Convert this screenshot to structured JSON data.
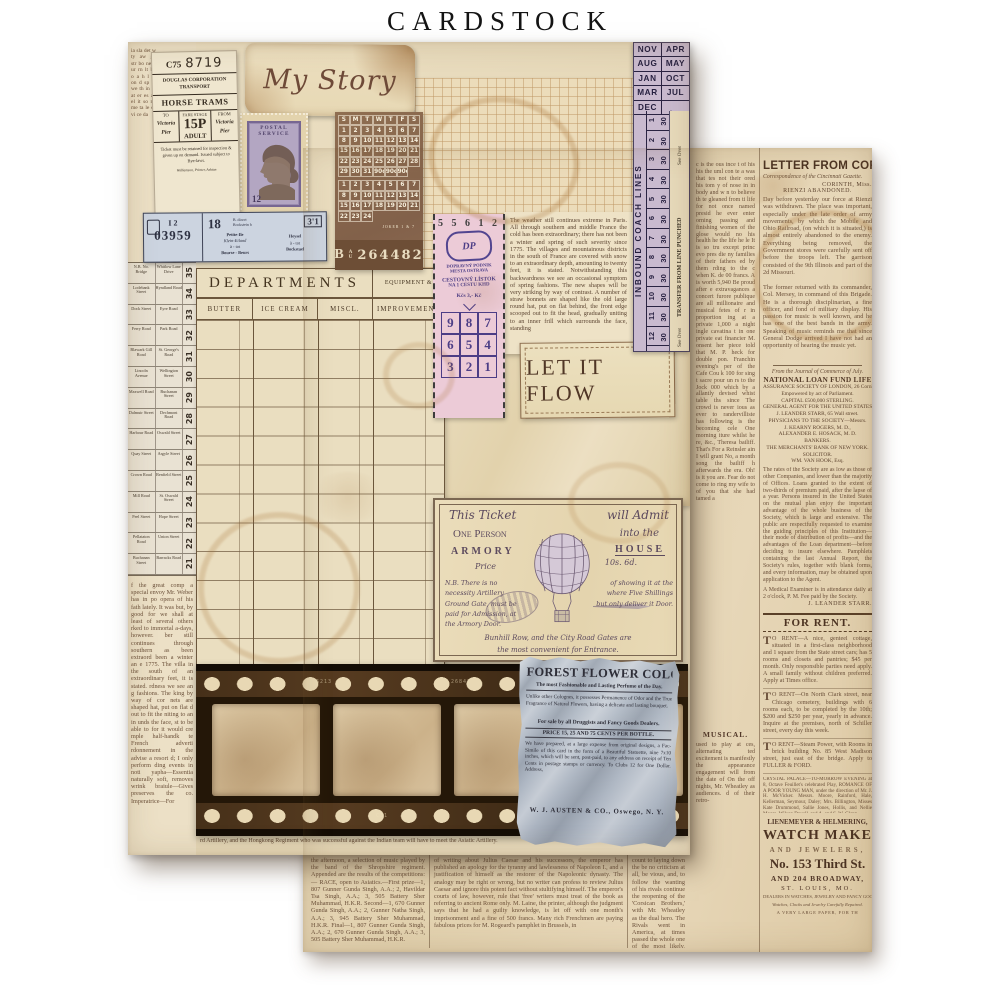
{
  "title": "CARDSTOCK",
  "palette": {
    "background": "#ffffff",
    "paper_cream": "#ece0c6",
    "newsprint_tan": "#e6d6b4",
    "ink_brown": "#5d4430",
    "ticket_lavender": "#c9bacf",
    "ticket_pink": "#eccbd7",
    "stamp_purple": "#4c3d86",
    "film_brown": "#2a1b0e",
    "cologne_blue": "#b9c1cb",
    "calendar_brown": "#8a6850"
  },
  "a": {
    "np_top": "ia sla det w ty aw go str bo ne y ur rn lt bo o a h l m on d sp ar we th in re at er es an el it so no me ta le os vi ce da",
    "np_left": "f the great comp a special envoy Mr. Weber has in po opera of his fath lately. It was but, by good for we shall at least of several others rked to immortal a-days, however. ber still continues through southern as been extraord been a winter an e 1775. The villa in the south of an extraordinary feet, it is stated. rdness we see an g fashions. The king by way of cor nets are shaped hat, put on flat d out to fit the niting to an in unds the face, st to be able to for it would cre mple half-handk te French adverti rdonnement in the advise a resort d; I only perform ding events in noti yapha—Essentia naturally soft, removes wrink braiule—Gives preserves the co. Imperatrice—For",
    "np_bottom": "rd Artillery, and the Hongkong Regiment who was successful against the Indian team will have to meet the Asiatic Artillery.",
    "bus": {
      "rows": [
        {
          "a": "N.B. No. Bridge",
          "b": "Whitlow Lane Drive",
          "n": "35"
        },
        {
          "a": "Lodebank Street",
          "b": "Hyndland Road",
          "n": "34"
        },
        {
          "a": "Dock Street",
          "b": "Eyre Road",
          "n": "33"
        },
        {
          "a": "Ferry Road",
          "b": "Park Road",
          "n": "32"
        },
        {
          "a": "Blawark Gill Road",
          "b": "St. George's Road",
          "n": "31"
        },
        {
          "a": "Lincoln Avenue",
          "b": "Wellington Street",
          "n": "30"
        },
        {
          "a": "Maxwell Road",
          "b": "Buchanan Street",
          "n": "29"
        },
        {
          "a": "Dalmuir Street",
          "b": "Dechmont Road",
          "n": "28"
        },
        {
          "a": "Harbour Road",
          "b": "Oswald Street",
          "n": "27"
        },
        {
          "a": "Quay Street",
          "b": "Argyle Street",
          "n": "26"
        },
        {
          "a": "Crown Road",
          "b": "Renfield Street",
          "n": "25"
        },
        {
          "a": "Mill Road",
          "b": "St. Oswald Street",
          "n": "24"
        },
        {
          "a": "Peel Street",
          "b": "Hope Street",
          "n": "23"
        },
        {
          "a": "Pellataton Road",
          "b": "Union Street",
          "n": "22"
        },
        {
          "a": "Buchanan Street",
          "b": "Barracks Road",
          "n": "21"
        }
      ]
    },
    "horse": {
      "c": "C75",
      "num": "8719",
      "co1": "DOUGLAS CORPORATION",
      "co2": "TRANSPORT",
      "name": "HORSE TRAMS",
      "to": "TO",
      "fare": "FARE STAGE",
      "from": "FROM",
      "to_v1": "Victoria",
      "to_v2": "Pier",
      "fare_v": "15P",
      "fare_c": "ADULT",
      "from_v1": "Victoria",
      "from_v2": "Pier",
      "cond": "Ticket must be retained for inspection & given up on demand. Issued subject to Bye-laws.",
      "printer": "Williamson, Printer, Ashton"
    },
    "story": "My Story",
    "stamp": {
      "h": "POSTAL SERVICE",
      "v": "12"
    },
    "cal": {
      "days": [
        "S",
        "M",
        "T",
        "W",
        "T",
        "F",
        "S"
      ],
      "m1": [
        "1",
        "2",
        "3",
        "4",
        "5",
        "6",
        "7",
        "8",
        "9",
        "10",
        "11",
        "12",
        "13",
        "14",
        "15",
        "16",
        "17",
        "18",
        "19",
        "20",
        "21",
        "22",
        "23",
        "24",
        "25",
        "26",
        "27",
        "28",
        "29",
        "30",
        "31",
        "90c",
        "90c",
        "90c"
      ],
      "m2": [
        "1",
        "2",
        "3",
        "4",
        "5",
        "6",
        "7",
        "8",
        "9",
        "10",
        "11",
        "12",
        "13",
        "14",
        "15",
        "16",
        "17",
        "18",
        "19",
        "20",
        "21",
        "22",
        "23",
        "24"
      ],
      "note": "JOKER 1 & 7"
    },
    "serial": {
      "p": "B",
      "sup": "A",
      "sub": "U",
      "n": "264482"
    },
    "blue": {
      "s1": "I 2",
      "s2": "03959",
      "n": "18",
      "note1": "B. direct",
      "note2": "Bockstein b",
      "fare": "3'1",
      "l1": "Petite-Ile",
      "l2": "Klein-Eiland",
      "l3": "à - tot",
      "l4": "Bourse - Beurs",
      "r1": "Heysel",
      "r2": "à - tot",
      "r3": "Bockstael"
    },
    "strip": {
      "months": [
        {
          "l": "NOV",
          "r": "APR"
        },
        {
          "l": "AUG",
          "r": "MAY"
        },
        {
          "l": "JAN",
          "r": "OCT"
        },
        {
          "l": "MAR",
          "r": "JUL"
        },
        {
          "l": "DEC",
          "r": ""
        }
      ],
      "rows": [
        {
          "n": "1",
          "v": "30"
        },
        {
          "n": "2",
          "v": "30"
        },
        {
          "n": "3",
          "v": "30"
        },
        {
          "n": "4",
          "v": "30"
        },
        {
          "n": "5",
          "v": "30"
        },
        {
          "n": "6",
          "v": "30"
        },
        {
          "n": "7",
          "v": "30"
        },
        {
          "n": "8",
          "v": "30"
        },
        {
          "n": "9",
          "v": "30"
        },
        {
          "n": "10",
          "v": "30"
        },
        {
          "n": "11",
          "v": "30"
        },
        {
          "n": "12",
          "v": "30"
        }
      ],
      "inbound": "INBOUND COACH LINES",
      "see": "See Over",
      "transfer": "TRANSFER FROM LINE PUNCHED"
    },
    "pink": {
      "serial": "5 5 6 1 2",
      "logo": "DP",
      "co1": "DOPRAVNÝ PODNIK",
      "co2": "MESTA OSTRAVA",
      "t1": "CESTOVNÝ LÍSTOK",
      "t2": "NA 1 CESTU KHD",
      "price": "Kčs 3,- Kč",
      "digits": [
        "9",
        "8",
        "7",
        "6",
        "5",
        "4",
        "3",
        "2",
        "1"
      ]
    },
    "weather": "The weather still continues extreme in Paris. All through southern and middle France the cold has been extraordinary; there has not been a winter and spring of such severity since 1775. The villages and mountainous districts in the south of France are covered with snow to an extraordinary depth, amounting to twenty feet, it is stated. Notwithstanding this backwardness we see an occasional symptom of spring fashions. The new shapes will be very striking by way of contrast. A number of straw bonnets are shaped like the old large round hat, put on flat behind, the front edge scooped out to fit the head, gradually uniting to an inner frill which surrounds the face, standing",
    "dept": {
      "title": "DEPARTMENTS",
      "corner": "EQUIPMENT &",
      "cols": [
        "BUTTER",
        "ICE CREAM",
        "MISCL.",
        "IMPROVEMENT"
      ]
    },
    "flow": "LET IT FLOW",
    "armory": {
      "r1a": "This Ticket",
      "r1b": "will Admit",
      "r2a": "One Person",
      "r2b": "into the",
      "r3a": "ARMORY",
      "r3b": "HOUSE",
      "pl": "Price",
      "pv": "10s. 6d.",
      "bl": "N.B. There is no necessity Artillery Ground Gate, must be paid for Admission, at the Armory Door.",
      "br": "of showing it at the where Five Shillings but only deliver it Door.",
      "f1": "Bunhill Row, and the City Road Gates are",
      "f2": "the most convenient for Entrance."
    },
    "film": {
      "m1": "6213",
      "m2": "26847",
      "m3": "57",
      "m4": "C31",
      "m5": "110"
    },
    "cologne": {
      "title": "FOREST FLOWER COLOGNE,",
      "sub": "The most Fashionable and Lasting Perfume of the Day.",
      "p1": "Unlike other Colognes, it possesses Permanence of Odor and the True Fragrance of Natural Flowers, having a delicate and lasting bouquet.",
      "sale": "For sale by all Druggists and Fancy Goods Dealers.",
      "price": "PRICE 15, 25 AND 75 CENTS PER BOTTLE.",
      "p2": "We have prepared, at a large expense from original designs, a Fac-Simile of this card in the form of a Beautiful Statuette, nine 7x10 inches, which will be sent, post-paid, to any address on receipt of Ten Cents in postage stamps or currency. To Clubs 12 for One Dollar. Address,",
      "sig": "W. J. AUSTEN & CO., Oswego, N. Y."
    }
  },
  "b": {
    "sliver": "c is the ous ince t of his his the uml con te a was that tes not their ored his tom y of nose in in body and w n to believe th te gleaned from ti life for not once named presid he ever enter orning passing and finishing women of the glose would no his health he the life he le It is so tru except princ evo pres die ny families of their fathers ed by them rding to the c when K. de 00 francs. A is worth 5,940 Be proud after e extravagances a concert furore publique are all millionaire and musical fetes of r in proportion ing at a private 1,000 a night ingle cavatina t in one private eat financier M. onsent her piece told that M. P. heck for double pon. Franchin evening's per of the Cafe Cou k 100 for sing t sacre pour un rs to the Jock 000 which by a allantly devised whist table ths since The crowd is never ious as ever to randervilliste has following is the becoming cele One morning iture whilst he re, &c., Theresa bailiff. That's For a Reinsler ain I will grant No, a month song the bailiff h afterwards the era. Oh! is it you are. Fear do not come to ring my wife to of you that she had tamed a",
    "musical_h": "MUSICAL.",
    "musical": "used to play at ces, alternating ted excitement is manifestly the appearance engagement will from the date of On the off nights, Mr. Wheatley as audiences. d of their retro-",
    "headline": "LETTER FROM CORINTH.",
    "dateline": "Correspondence of the Cincinnati Gazette.",
    "place": "CORINTH, Miss.",
    "subhead": "RIENZI ABANDONED.",
    "art1": "Day before yesterday our force at Rienzi was withdrawn. The place was important, especially under the late order of army movements, by which the Mobile and Ohio Railroad, (on which it is situated,) is almost entirely abandoned to the enemy. Everything being removed, the Government stores were carefully sent off before the troops left. The garrison consisted of the 9th Illinois and part of the 2d Missouri.",
    "art2": "The former returned with its commander, Col. Mersey, in command of this Brigade. He is a thorough disciplinarian, a fine officer, and fond of military display. His passion for music is well known, and he has one of the best bands in the army. Speaking of music reminds me that since General Dodge arrived I have not had an opportunity of hearing the music yet.",
    "credit": "From the Journal of Commerce of July.",
    "natl_title": "NATIONAL LOAN FUND LIFE",
    "natl_lines": [
      "ASSURANCE SOCIETY OF LONDON, 26 Cornhill.",
      "Empowered by act of Parliament.",
      "CAPITAL £500,000 STERLING.",
      "GENERAL AGENT FOR THE UNITED STATES,",
      "J. LEANDER STARR, 65 Wall street.",
      "PHYSICIANS TO THE SOCIETY—Messrs.",
      "J. KEARNY ROGERS, M. D.,",
      "ALEXANDER E. HOSACK, M. D.",
      "BANKERS.",
      "THE MERCHANTS' BANK OF NEW YORK.",
      "SOLICITOR.",
      "WM. VAN HOOK, Esq."
    ],
    "natl_body": "The rates of the Society are as low as those of other Companies, and lower than the majority of Offices. Loans granted to the extent of two-thirds of premium paid, after the lapse of a year. Persons insured in the United States on the mutual plan enjoy the important advantage of the whole business of the Society, which is large and extensive. The public are respectfully requested to examine the guiding principles of this Institution—their mode of distribution of profits—and the advantages of the Loan department—before deciding to insure elsewhere. Pamphlets containing the last Annual Report, the Society's rules, together with blank forms, and every information, may be obtained upon application to the Agent.",
    "examiner": "A Medical Examiner is in attendance daily at 2 o'clock, P. M. Fee paid by the Society.",
    "sig": "J. LEANDER STARR.",
    "rent_h": "FOR RENT.",
    "rent_ads": [
      "TO RENT—A nice, genteel cottage, situated in a first-class neighborhood and 1 square from the State street cars; has 5 rooms and closets and pantries; $45 per month. Only responsible parties need apply. A small family without children preferred. Apply at Times office.",
      "TO RENT—On North Clark street, near Chicago cemetery, buildings with 6 rooms each, to be completed by the 10th; $200 and $250 per year, yearly in advance. Inquire at the premises, north of Schiller street, every day this week.",
      "TO RENT—Steam Power, with Rooms in brick building No. 85 West Madison street, just east of the bridge. Apply to FULLER & FORD."
    ],
    "crystal": "CRYSTAL PALACE—TO-MORROW EVENING at 8, Octave Feuillet's celebrated Play, ROMANCE OF A POOR YOUNG MAN, under the direction of Mr. J. H. McVicker. Messrs. Moore, Rainford, Hale, Kellerman, Seymour, Daley; Mrs. Billington, Misses Kate Drummond, Sallie Jones, Hollis, and Nellie Moore, Wilson Duvell, and A. and S. W. Glenn.",
    "watch": {
      "w1": "LIENEMEYER & HELMERING,",
      "w2": "WATCH MAKERS",
      "w3": "AND JEWELERS,",
      "w4": "No. 153 Third St.",
      "w5": "AND 204 BROADWAY,",
      "w6": "ST. LOUIS, MO.",
      "w7": "DEALERS IN WATCHES, JEWELRY AND FANCY GOODS.",
      "w8": "Watches, Clocks and Jewelry Carefully Repaired.",
      "w9": "A VERY LARGE PAPER, FOR TH"
    },
    "cols": {
      "c1": "the afternoon, a selection of music played by the band of the Shropshire regiment. Appended are the results of the competitions:— RACE, open to Asiatics.—First prize—1, 807 Gunner Gunda Singh, A.A.; 2, Havildar Tsa Singh, A.A.; 3, 505 Battery Sher Muhammad, H.K.R. Second—1, 670 Gunner Gunda Singh, A.A.; 2, Gunner Natha Singh, A.A.; 3, 945 Battery Sher Muhammad, H.K.R. Final—1, 807 Gunner Gunda Singh, A.A.; 2, 670 Gunner Gunda Singh, A.A.; 3, 505 Battery Sher Muhammad, H.K.R.",
      "c2": "of writing about Julius Caesar and his successors, the emperor has published an apology for the tyranny and lawlessness of Napoleon I., and a justification of himself as the restorer of the Napoleonic dynasty. The analogy may be right or wrong, but no writer can profess to review Julius Caesar and ignore this potent fact without stultifying himself. The emperor's courts of law, however, rule that 'free' writers must treat of the book as referring to ancient Rome only. M. Laine, the printer, although the judgment says that he had a guilty knowledge, is let off with one month's imprisonment and a fine of 500 francs. Many rich Frenchmen are paying fabulous prices for M. Rogeard's pamphlet in Brussels, in",
      "c3": "count to laying down the be no criticism at all, be vious, and, to follow the wanting of his rivals continue the reopening of the 'Corsican Brothers,' with Mr. Wheatley as the dual hero. The Rivals went in America, at times passed the whole one of the most likely, Niblo's—during the coming summer and"
    }
  }
}
